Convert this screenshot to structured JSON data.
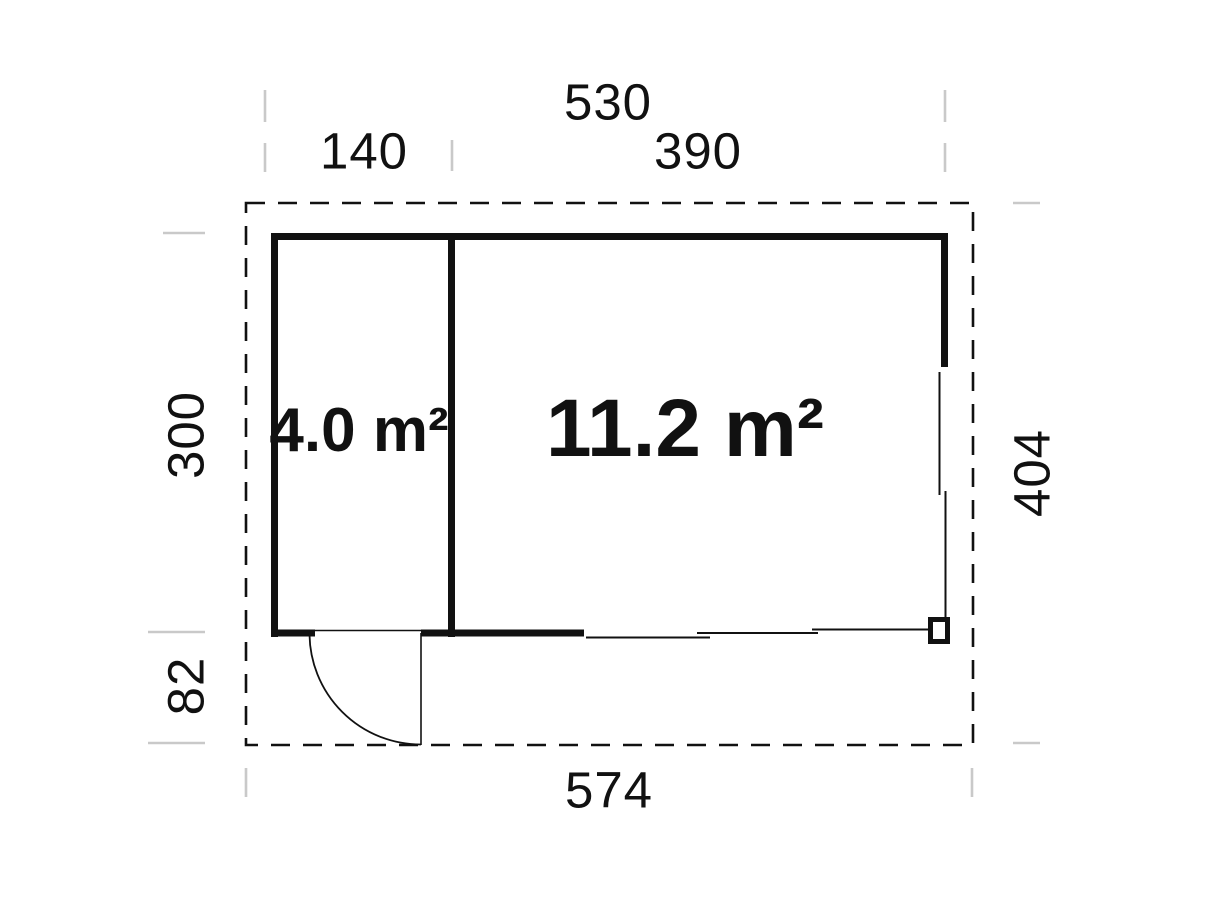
{
  "plan": {
    "type": "floor-plan",
    "rooms": {
      "small": {
        "area_label": "4.0 m²"
      },
      "large": {
        "area_label": "11.2 m²"
      }
    },
    "dimensions": {
      "top_total": "530",
      "top_left_section": "140",
      "top_right_section": "390",
      "left_room_depth": "300",
      "left_lower_offset": "82",
      "right_total_depth": "404",
      "bottom_total": "574"
    },
    "features": {
      "roof_outline": "dashed rectangle",
      "door": "outward quarter-circle swing, bottom left",
      "corner_post": "square post, bottom right"
    },
    "colors": {
      "line": "#111111",
      "tick": "#c9c9c9",
      "background": "#ffffff"
    }
  }
}
